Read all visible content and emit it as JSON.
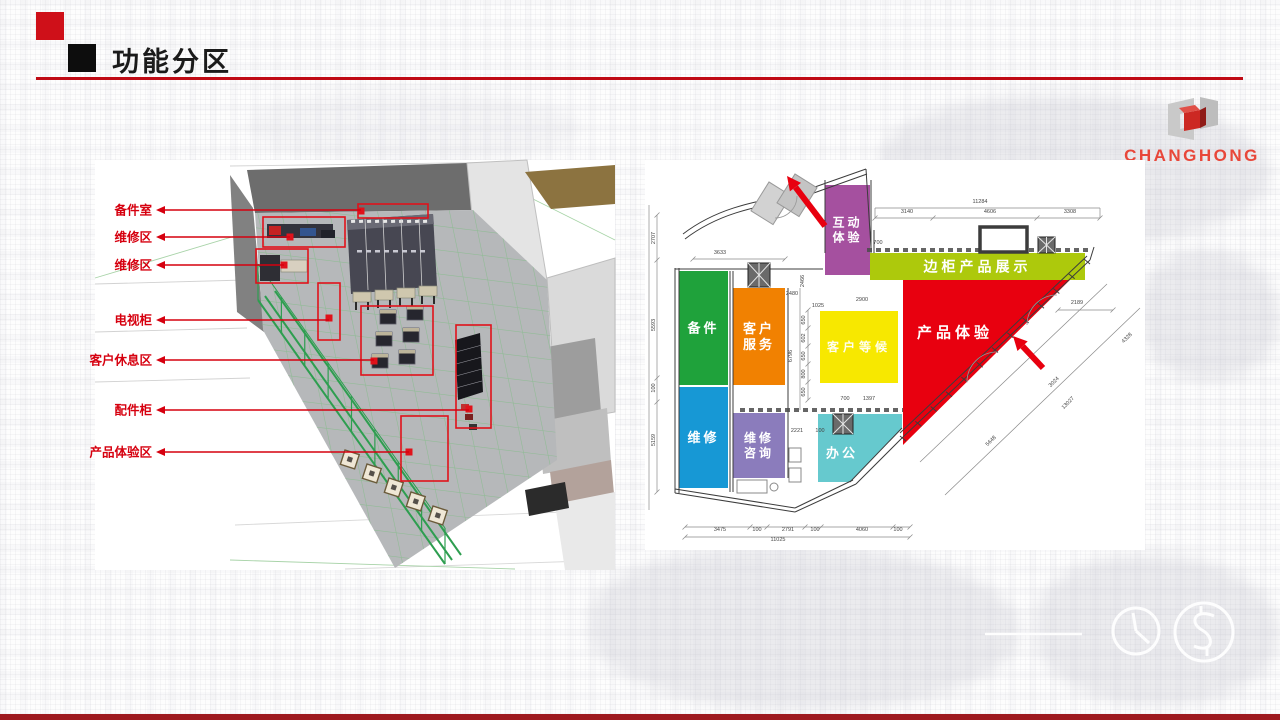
{
  "slide": {
    "title": "功能分区",
    "accent_red": "#c00b15",
    "marker_red": "#cf1019",
    "marker_black": "#0d0d0d",
    "bottom_bar_color": "#9e1a1f"
  },
  "logo": {
    "text": "CHANGHONG",
    "color": "#e8473a"
  },
  "render3d": {
    "label_color": "#d6000f",
    "annotation_color": "#e0121b",
    "labels": [
      {
        "text": "备件室",
        "y": 50,
        "endX": 266
      },
      {
        "text": "维修区",
        "y": 77,
        "endX": 195
      },
      {
        "text": "维修区",
        "y": 105,
        "endX": 189
      },
      {
        "text": "电视柜",
        "y": 160,
        "endX": 234
      },
      {
        "text": "客户休息区",
        "y": 200,
        "endX": 279
      },
      {
        "text": "配件柜",
        "y": 250,
        "endX": 374
      },
      {
        "text": "产品体验区",
        "y": 292,
        "endX": 314
      }
    ]
  },
  "floorplan": {
    "zones": [
      {
        "name": "互动体验",
        "lines": [
          "互动",
          "体验"
        ],
        "color": "#a5509f",
        "shape": "rect",
        "x": 180,
        "y": 25,
        "w": 45,
        "h": 90,
        "fs": 12
      },
      {
        "name": "产品体验",
        "lines": [
          "产品体验"
        ],
        "color": "#e8000f",
        "shape": "poly",
        "points": "258,120 432,113 258,285",
        "tx": 310,
        "ty": 172,
        "fs": 15
      },
      {
        "name": "边柜产品展示",
        "lines": [
          "边柜产品展示"
        ],
        "color": "#adc90c",
        "shape": "rect",
        "x": 225,
        "y": 93,
        "w": 215,
        "h": 27,
        "fs": 14
      },
      {
        "name": "备件",
        "lines": [
          "备件"
        ],
        "color": "#1fa23b",
        "shape": "rect",
        "x": 34,
        "y": 111,
        "w": 49,
        "h": 114,
        "fs": 13
      },
      {
        "name": "客户服务",
        "lines": [
          "客户",
          "服务"
        ],
        "color": "#f18101",
        "shape": "rect",
        "x": 88,
        "y": 128,
        "w": 52,
        "h": 97,
        "fs": 13
      },
      {
        "name": "客户等候",
        "lines": [
          "客户等候"
        ],
        "color": "#f7e800",
        "shape": "rect",
        "x": 175,
        "y": 151,
        "w": 78,
        "h": 72,
        "fs": 12,
        "tcolor": "rgba(255,255,255,.93)"
      },
      {
        "name": "维修",
        "lines": [
          "维修"
        ],
        "color": "#1798d5",
        "shape": "rect",
        "x": 34,
        "y": 227,
        "w": 49,
        "h": 101,
        "fs": 13
      },
      {
        "name": "维修咨询",
        "lines": [
          "维修",
          "咨询"
        ],
        "color": "#8b7cbc",
        "shape": "rect",
        "x": 88,
        "y": 253,
        "w": 52,
        "h": 65,
        "fs": 12
      },
      {
        "name": "办公",
        "lines": [
          "办公"
        ],
        "color": "#66c9ce",
        "shape": "poly",
        "points": "173,254 257,254 257,268 205,322 173,322",
        "tx": 197,
        "ty": 293,
        "fs": 13
      }
    ],
    "dim_labels": [
      {
        "t": "11284",
        "x": 335,
        "y": 43
      },
      {
        "t": "3140",
        "x": 262,
        "y": 53
      },
      {
        "t": "4606",
        "x": 345,
        "y": 53
      },
      {
        "t": "3308",
        "x": 425,
        "y": 53
      },
      {
        "t": "700",
        "x": 233,
        "y": 84
      },
      {
        "t": "3633",
        "x": 75,
        "y": 94
      },
      {
        "t": "2707",
        "x": 10,
        "y": 78,
        "r": -90
      },
      {
        "t": "5593",
        "x": 10,
        "y": 165,
        "r": -90
      },
      {
        "t": "100",
        "x": 10,
        "y": 228,
        "r": -90
      },
      {
        "t": "5159",
        "x": 10,
        "y": 280,
        "r": -90
      },
      {
        "t": "2466",
        "x": 159,
        "y": 121,
        "r": -90
      },
      {
        "t": "2480",
        "x": 147,
        "y": 135
      },
      {
        "t": "1025",
        "x": 173,
        "y": 147
      },
      {
        "t": "2900",
        "x": 217,
        "y": 141
      },
      {
        "t": "6796",
        "x": 147,
        "y": 196,
        "r": -90
      },
      {
        "t": "650",
        "x": 160,
        "y": 160,
        "r": -90
      },
      {
        "t": "602",
        "x": 160,
        "y": 178,
        "r": -90
      },
      {
        "t": "650",
        "x": 160,
        "y": 196,
        "r": -90
      },
      {
        "t": "800",
        "x": 160,
        "y": 214,
        "r": -90
      },
      {
        "t": "650",
        "x": 160,
        "y": 232,
        "r": -90
      },
      {
        "t": "700",
        "x": 200,
        "y": 240
      },
      {
        "t": "1397",
        "x": 224,
        "y": 240
      },
      {
        "t": "2221",
        "x": 152,
        "y": 272
      },
      {
        "t": "100",
        "x": 175,
        "y": 272
      },
      {
        "t": "3475",
        "x": 75,
        "y": 371
      },
      {
        "t": "100",
        "x": 112,
        "y": 371
      },
      {
        "t": "2791",
        "x": 143,
        "y": 371
      },
      {
        "t": "100",
        "x": 170,
        "y": 371
      },
      {
        "t": "4060",
        "x": 217,
        "y": 371
      },
      {
        "t": "100",
        "x": 253,
        "y": 371
      },
      {
        "t": "11025",
        "x": 133,
        "y": 381
      },
      {
        "t": "2189",
        "x": 432,
        "y": 144
      },
      {
        "t": "4328",
        "x": 483,
        "y": 179,
        "r": -45
      },
      {
        "t": "3024",
        "x": 410,
        "y": 223,
        "r": -45
      },
      {
        "t": "13027",
        "x": 424,
        "y": 244,
        "r": -45
      },
      {
        "t": "5648",
        "x": 347,
        "y": 282,
        "r": -45
      }
    ]
  },
  "watermark": {
    "icons": [
      "clock-icon",
      "dollar-icon"
    ],
    "color": "#ffffff"
  }
}
